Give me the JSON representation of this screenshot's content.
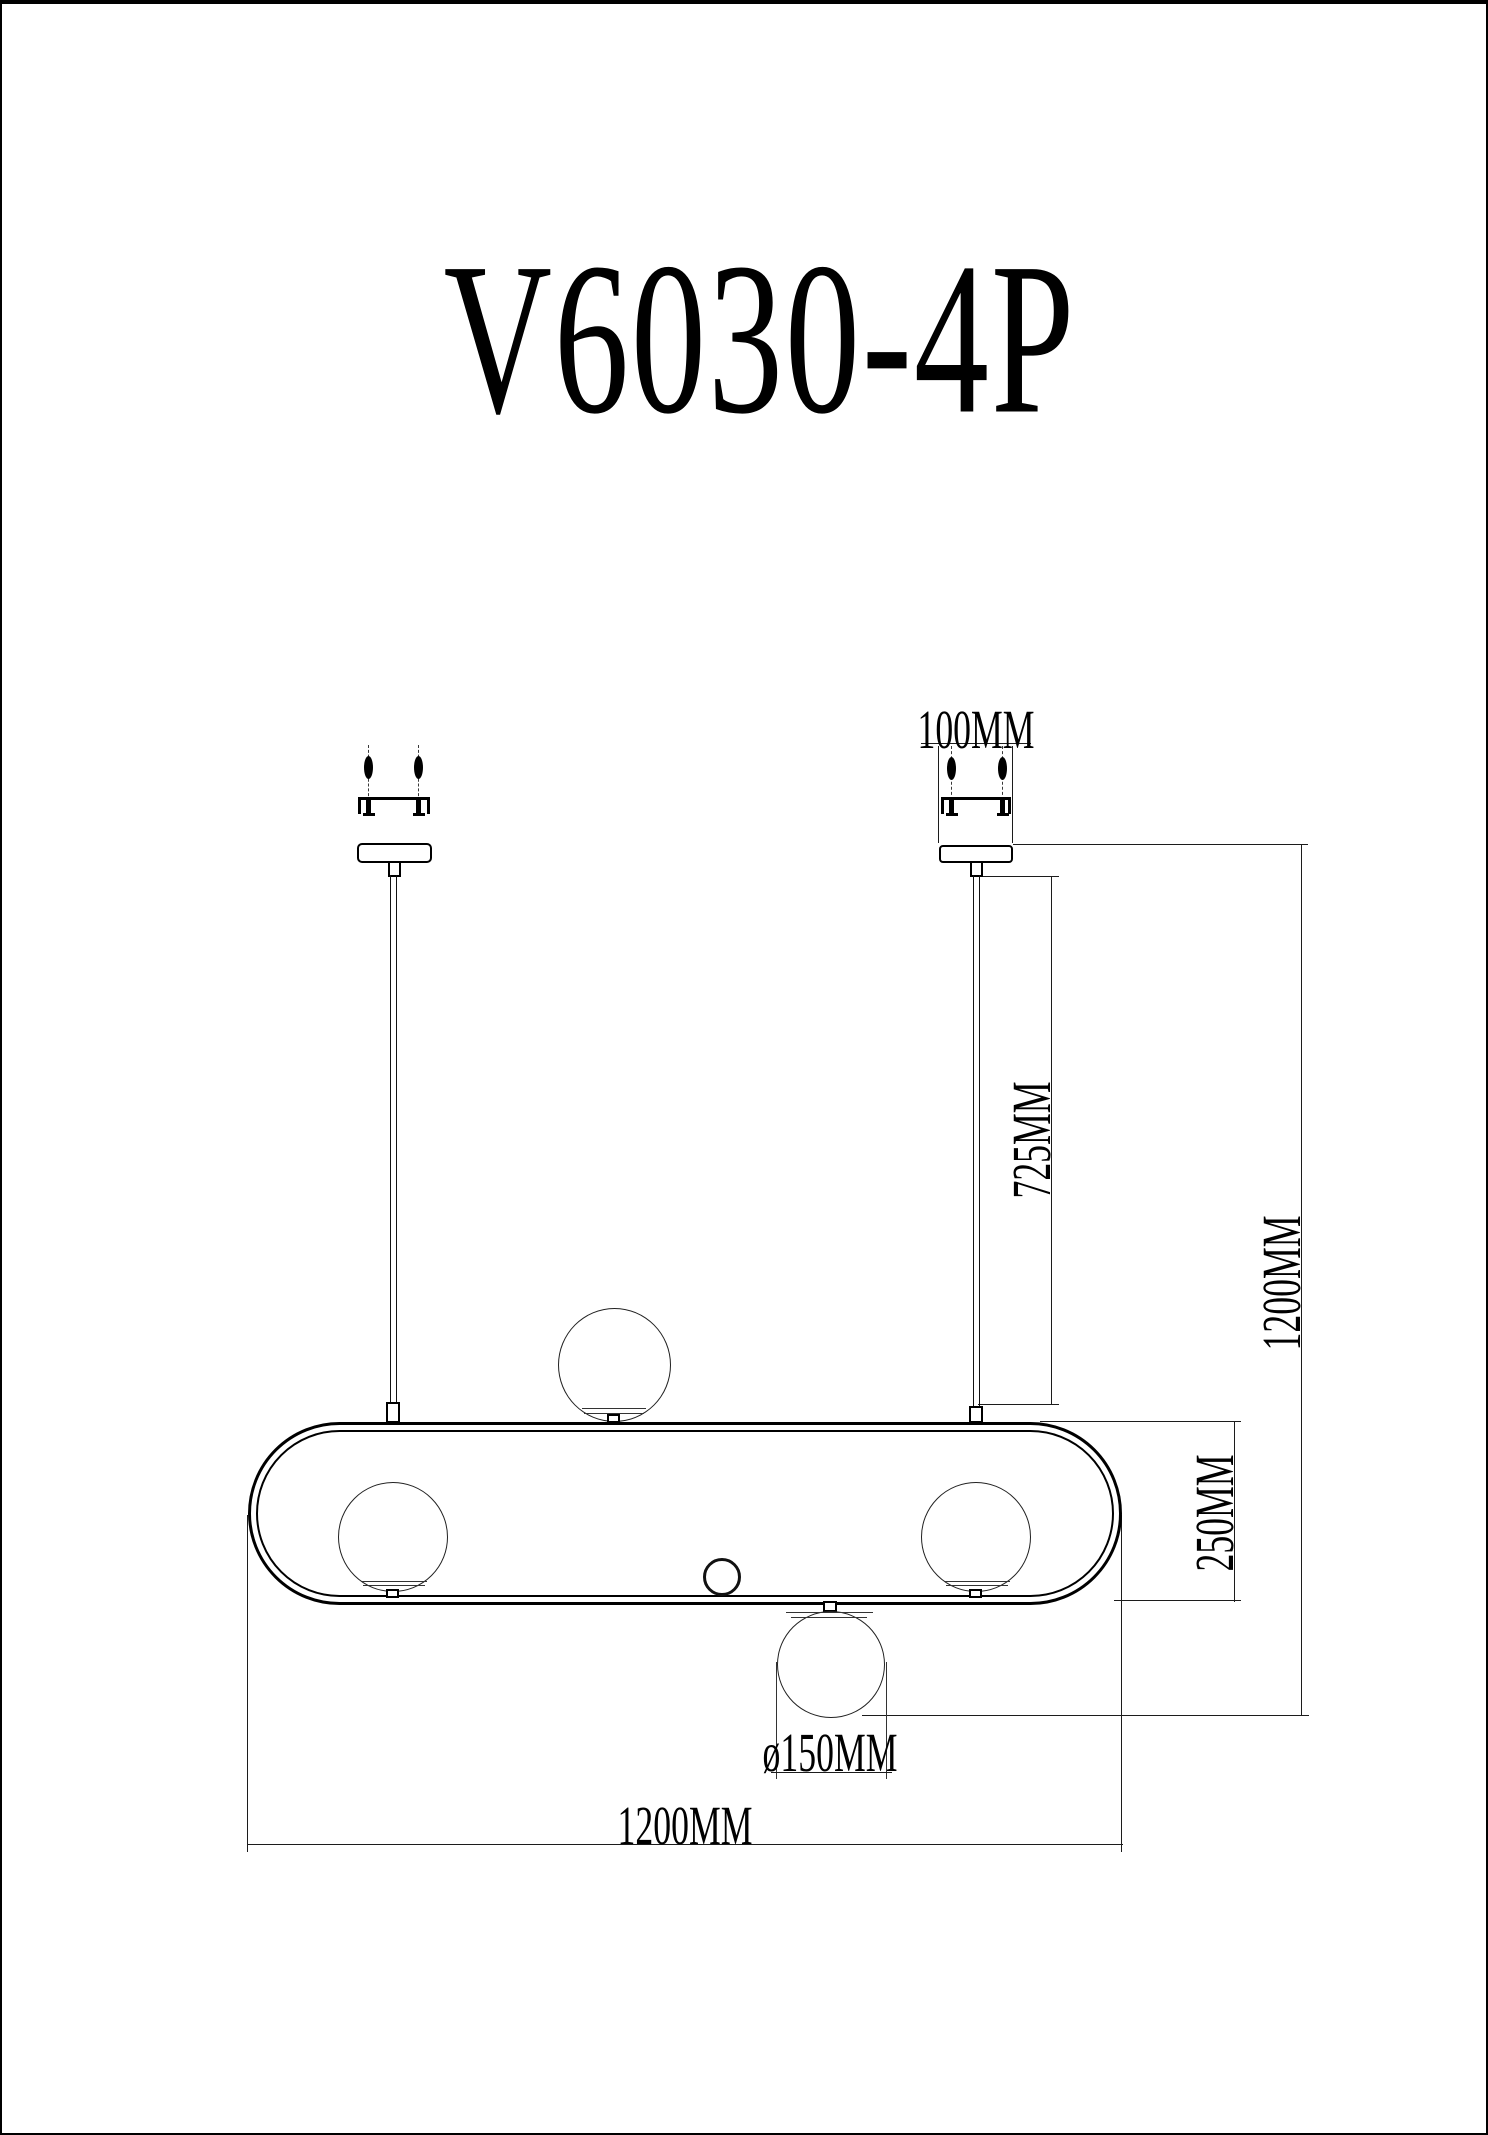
{
  "page": {
    "title": "V6030-4P"
  },
  "dimensions": {
    "canopy_width": "100MM",
    "rod_length": "725MM",
    "overall_height": "1200MM",
    "frame_height": "250MM",
    "shade_diameter": "ø150MM",
    "fixture_width": "1200MM"
  }
}
